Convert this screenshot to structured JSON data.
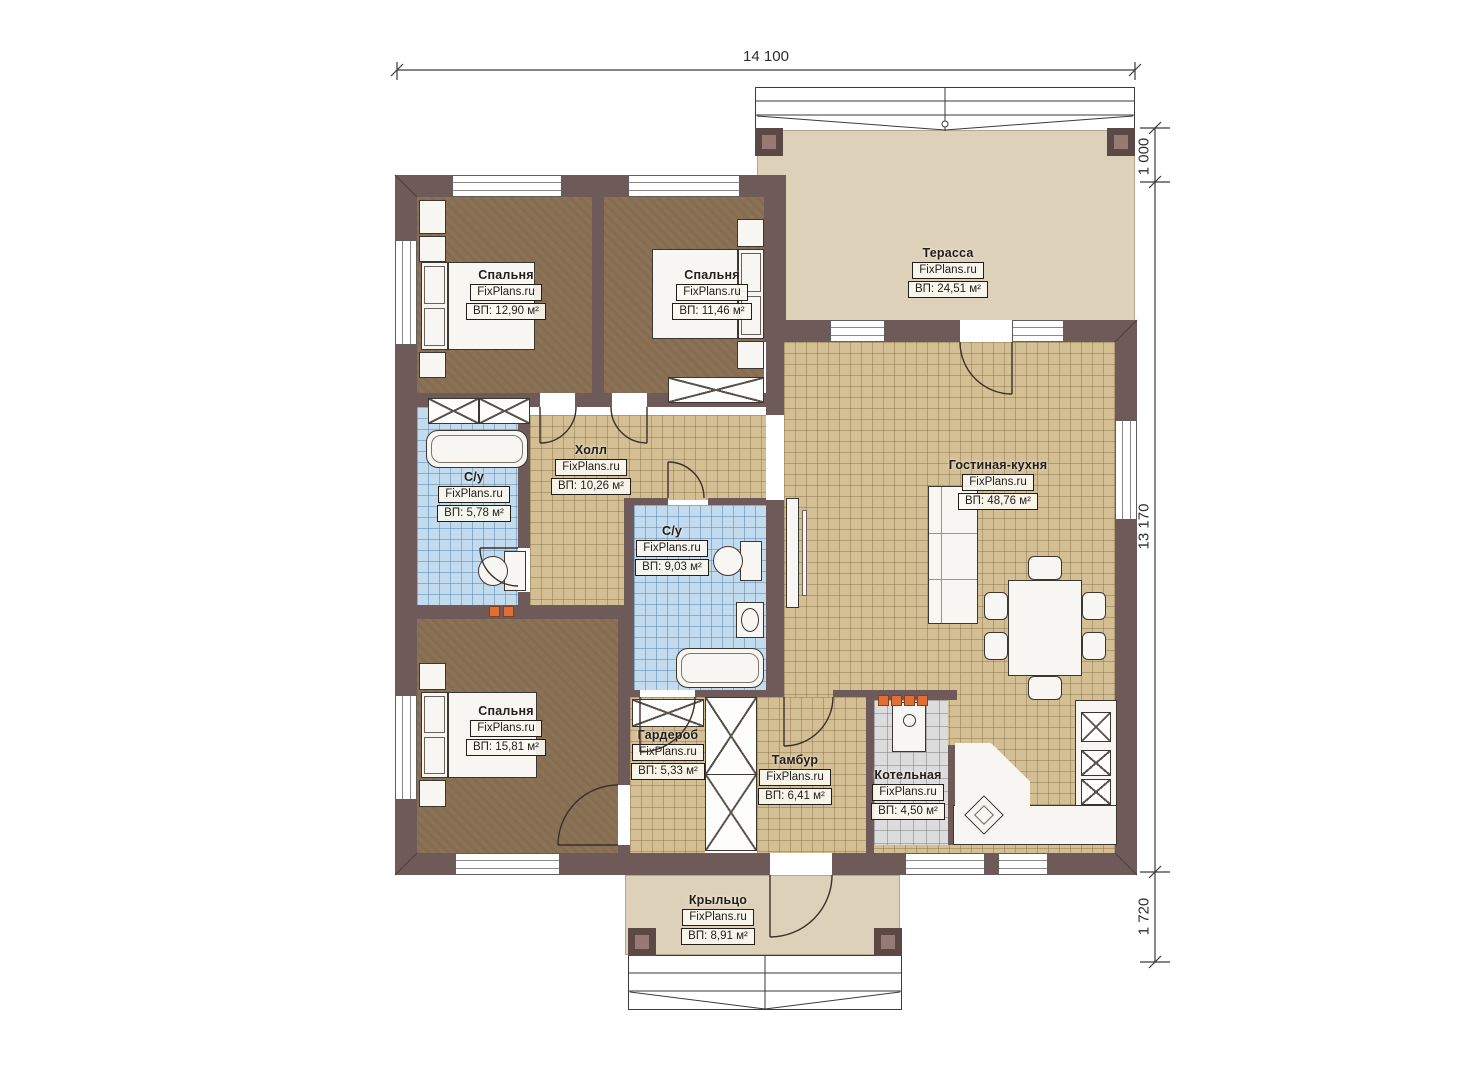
{
  "plan": {
    "brand": "FixPlans.ru",
    "dimensions": {
      "width_top": "14 100",
      "right_upper": "1 000",
      "right_main": "13 170",
      "right_lower": "1 720"
    },
    "rooms": [
      {
        "id": "bedroom-top-left",
        "name": "Спальня",
        "brand": "FixPlans.ru",
        "area": "ВП: 12,90 м²"
      },
      {
        "id": "bedroom-top-right",
        "name": "Спальня",
        "brand": "FixPlans.ru",
        "area": "ВП: 11,46 м²"
      },
      {
        "id": "terrace",
        "name": "Терасса",
        "brand": "FixPlans.ru",
        "area": "ВП: 24,51 м²"
      },
      {
        "id": "hall",
        "name": "Холл",
        "brand": "FixPlans.ru",
        "area": "ВП: 10,26 м²"
      },
      {
        "id": "bathroom-left",
        "name": "С/у",
        "brand": "FixPlans.ru",
        "area": "ВП: 5,78 м²"
      },
      {
        "id": "bathroom-center",
        "name": "С/у",
        "brand": "FixPlans.ru",
        "area": "ВП: 9,03 м²"
      },
      {
        "id": "living-kitchen",
        "name": "Гостиная-кухня",
        "brand": "FixPlans.ru",
        "area": "ВП: 48,76 м²"
      },
      {
        "id": "bedroom-bottom",
        "name": "Спальня",
        "brand": "FixPlans.ru",
        "area": "ВП: 15,81 м²"
      },
      {
        "id": "wardrobe",
        "name": "Гардероб",
        "brand": "FixPlans.ru",
        "area": "ВП: 5,33 м²"
      },
      {
        "id": "vestibule",
        "name": "Тамбур",
        "brand": "FixPlans.ru",
        "area": "ВП: 6,41 м²"
      },
      {
        "id": "boiler-room",
        "name": "Котельная",
        "brand": "FixPlans.ru",
        "area": "ВП: 4,50 м²"
      },
      {
        "id": "porch",
        "name": "Крыльцо",
        "brand": "FixPlans.ru",
        "area": "ВП: 8,91 м²"
      }
    ],
    "colors": {
      "wall": "#6e5a58",
      "bedroom_floor": "#8b7256",
      "tile_beige": "#d4bf95",
      "tile_blue": "#c2dbee",
      "tile_gray": "#dcdcdc",
      "terrace": "#ddd1b9",
      "radiator": "#e06f35"
    }
  }
}
